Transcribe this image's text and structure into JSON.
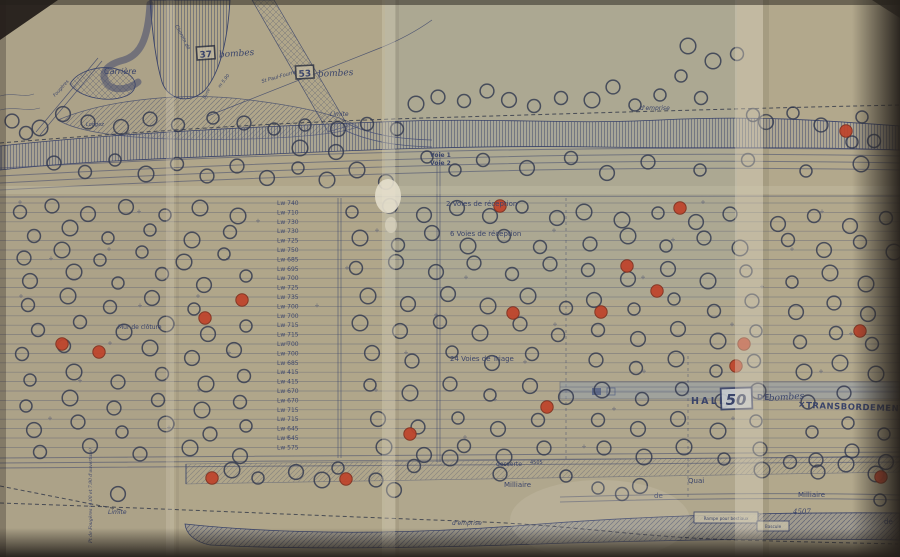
{
  "photo": {
    "paper": "#b2a88d",
    "ink": "#2e3a68",
    "red": "#c23a22",
    "dark_edge": "#241f1a",
    "fold_light": "#ddd6c1"
  },
  "bomb_boxes": [
    {
      "count": "37",
      "word": "bombes",
      "x": 197,
      "y": 57,
      "rot": -4
    },
    {
      "count": "53",
      "word": "bombes",
      "x": 296,
      "y": 76,
      "rot": -3
    }
  ],
  "halle": {
    "word1": "HALLE",
    "count": "50",
    "word2": "DE",
    "hand": "bombes",
    "mark": "×",
    "word3": "TRANSBORDEMENT"
  },
  "labels": [
    {
      "text": "Carrière",
      "x": 104,
      "y": 74,
      "size": 8,
      "italic": true
    },
    {
      "text": "Limite",
      "x": 330,
      "y": 116,
      "size": 6,
      "italic": true
    },
    {
      "text": "d'emprise",
      "x": 640,
      "y": 110,
      "size": 6,
      "italic": true
    },
    {
      "text": "Voie 1",
      "x": 430,
      "y": 157,
      "size": 6,
      "bold": true
    },
    {
      "text": "Voie 2",
      "x": 430,
      "y": 165,
      "size": 6,
      "bold": true
    },
    {
      "text": "2 Voies de réception",
      "x": 446,
      "y": 206,
      "size": 7
    },
    {
      "text": "6 Voies de réception",
      "x": 450,
      "y": 236,
      "size": 7
    },
    {
      "text": "24 Voies de Triage",
      "x": 450,
      "y": 361,
      "size": 7
    },
    {
      "text": "Mur de clôture",
      "x": 118,
      "y": 329,
      "size": 6
    },
    {
      "text": "desserte",
      "x": 496,
      "y": 466,
      "size": 6
    },
    {
      "text": "4505",
      "x": 530,
      "y": 464,
      "size": 5
    },
    {
      "text": "Milliaire",
      "x": 504,
      "y": 487,
      "size": 7
    },
    {
      "text": "Quai",
      "x": 688,
      "y": 483,
      "size": 7
    },
    {
      "text": "de",
      "x": 654,
      "y": 498,
      "size": 7
    },
    {
      "text": "Milliaire",
      "x": 798,
      "y": 497,
      "size": 7
    },
    {
      "text": "de",
      "x": 884,
      "y": 524,
      "size": 7
    },
    {
      "text": "Limite",
      "x": 108,
      "y": 514,
      "size": 6,
      "italic": true
    },
    {
      "text": "d'emprise",
      "x": 452,
      "y": 525,
      "size": 6,
      "italic": true
    },
    {
      "text": "4507",
      "x": 793,
      "y": 514,
      "size": 7,
      "hand": true
    },
    {
      "text": "Chemin de",
      "x": 175,
      "y": 26,
      "size": 5,
      "italic": true,
      "rot": 62
    },
    {
      "text": "St Paul-Fourne",
      "x": 262,
      "y": 83,
      "size": 5,
      "italic": true,
      "rot": -16
    },
    {
      "text": "m 5.90",
      "x": 220,
      "y": 88,
      "size": 4.5,
      "italic": true,
      "rot": -52
    },
    {
      "text": "Buse",
      "x": 205,
      "y": 99,
      "size": 4.5,
      "italic": true,
      "rot": -62
    },
    {
      "text": "Fougères",
      "x": 55,
      "y": 97,
      "size": 4.5,
      "italic": true,
      "rot": -48
    },
    {
      "text": "Longez",
      "x": 86,
      "y": 126,
      "size": 5,
      "italic": true
    },
    {
      "text": "Pt de Fougères (4.00 et 7.90 d'ouverture)",
      "x": 92,
      "y": 543,
      "size": 4.5,
      "rot": -90,
      "hand": true
    }
  ],
  "boxed_labels": [
    {
      "text": "Rampe pour bestiaux",
      "x": 694,
      "y": 512,
      "w": 64,
      "h": 11
    },
    {
      "text": "Bascule",
      "x": 757,
      "y": 521,
      "w": 32,
      "h": 10
    }
  ],
  "track_labels": [
    "Lw 740",
    "Lw 710",
    "Lw 730",
    "Lw 730",
    "Lw 725",
    "Lw 750",
    "Lw 685",
    "Lw 695",
    "Lw 700",
    "Lw 725",
    "Lw 735",
    "Lw 700",
    "Lw 700",
    "Lw 715",
    "Lw 715",
    "Lw 700",
    "Lw 700",
    "Lw 685",
    "Lw 415",
    "Lw 415",
    "Lw 670",
    "Lw 670",
    "Lw 715",
    "Lw 715",
    "Lw 645",
    "Lw 645",
    "Lw 575"
  ],
  "yard": {
    "rows": 27,
    "y0": 203,
    "dy": 9.4,
    "label_x": 277
  },
  "craters": {
    "black": [
      [
        688,
        46
      ],
      [
        713,
        61
      ],
      [
        737,
        54
      ],
      [
        416,
        104
      ],
      [
        438,
        97
      ],
      [
        464,
        101
      ],
      [
        487,
        91
      ],
      [
        509,
        100
      ],
      [
        534,
        106
      ],
      [
        561,
        98
      ],
      [
        592,
        100
      ],
      [
        613,
        87
      ],
      [
        635,
        105
      ],
      [
        660,
        95
      ],
      [
        681,
        76
      ],
      [
        701,
        98
      ],
      [
        753,
        115
      ],
      [
        766,
        122
      ],
      [
        793,
        113
      ],
      [
        821,
        125
      ],
      [
        852,
        142
      ],
      [
        874,
        141
      ],
      [
        862,
        117
      ],
      [
        12,
        121
      ],
      [
        26,
        133
      ],
      [
        40,
        128
      ],
      [
        63,
        114
      ],
      [
        88,
        122
      ],
      [
        121,
        127
      ],
      [
        150,
        119
      ],
      [
        178,
        125
      ],
      [
        213,
        118
      ],
      [
        244,
        123
      ],
      [
        274,
        129
      ],
      [
        305,
        125
      ],
      [
        338,
        129
      ],
      [
        367,
        124
      ],
      [
        397,
        129
      ],
      [
        54,
        163
      ],
      [
        85,
        172
      ],
      [
        115,
        160
      ],
      [
        146,
        174
      ],
      [
        177,
        164
      ],
      [
        207,
        176
      ],
      [
        237,
        166
      ],
      [
        267,
        178
      ],
      [
        298,
        168
      ],
      [
        327,
        180
      ],
      [
        357,
        170
      ],
      [
        386,
        182
      ],
      [
        300,
        148
      ],
      [
        336,
        152
      ],
      [
        427,
        157
      ],
      [
        455,
        170
      ],
      [
        483,
        160
      ],
      [
        527,
        168
      ],
      [
        571,
        158
      ],
      [
        607,
        173
      ],
      [
        648,
        162
      ],
      [
        700,
        170
      ],
      [
        748,
        160
      ],
      [
        806,
        171
      ],
      [
        861,
        164
      ],
      [
        20,
        212
      ],
      [
        52,
        206
      ],
      [
        88,
        214
      ],
      [
        126,
        207
      ],
      [
        165,
        215
      ],
      [
        200,
        208
      ],
      [
        238,
        216
      ],
      [
        352,
        212
      ],
      [
        390,
        206
      ],
      [
        424,
        215
      ],
      [
        457,
        208
      ],
      [
        490,
        216
      ],
      [
        522,
        207
      ],
      [
        557,
        218
      ],
      [
        584,
        212
      ],
      [
        622,
        220
      ],
      [
        658,
        213
      ],
      [
        696,
        222
      ],
      [
        730,
        214
      ],
      [
        778,
        224
      ],
      [
        814,
        216
      ],
      [
        850,
        226
      ],
      [
        886,
        218
      ],
      [
        34,
        236
      ],
      [
        70,
        228
      ],
      [
        108,
        238
      ],
      [
        150,
        230
      ],
      [
        192,
        240
      ],
      [
        230,
        232
      ],
      [
        360,
        238
      ],
      [
        398,
        245
      ],
      [
        432,
        233
      ],
      [
        468,
        246
      ],
      [
        504,
        236
      ],
      [
        540,
        247
      ],
      [
        590,
        244
      ],
      [
        628,
        236
      ],
      [
        666,
        246
      ],
      [
        704,
        238
      ],
      [
        740,
        248
      ],
      [
        788,
        240
      ],
      [
        824,
        250
      ],
      [
        860,
        242
      ],
      [
        894,
        252
      ],
      [
        24,
        258
      ],
      [
        62,
        250
      ],
      [
        100,
        260
      ],
      [
        142,
        252
      ],
      [
        184,
        262
      ],
      [
        224,
        254
      ],
      [
        356,
        268
      ],
      [
        396,
        262
      ],
      [
        436,
        272
      ],
      [
        474,
        263
      ],
      [
        512,
        274
      ],
      [
        550,
        264
      ],
      [
        588,
        270
      ],
      [
        628,
        279
      ],
      [
        668,
        269
      ],
      [
        708,
        281
      ],
      [
        746,
        271
      ],
      [
        792,
        282
      ],
      [
        830,
        273
      ],
      [
        866,
        284
      ],
      [
        30,
        281
      ],
      [
        74,
        272
      ],
      [
        118,
        283
      ],
      [
        162,
        274
      ],
      [
        204,
        285
      ],
      [
        246,
        276
      ],
      [
        28,
        305
      ],
      [
        68,
        296
      ],
      [
        110,
        307
      ],
      [
        152,
        298
      ],
      [
        194,
        309
      ],
      [
        368,
        296
      ],
      [
        408,
        304
      ],
      [
        448,
        294
      ],
      [
        488,
        306
      ],
      [
        528,
        296
      ],
      [
        566,
        308
      ],
      [
        594,
        300
      ],
      [
        634,
        309
      ],
      [
        674,
        299
      ],
      [
        714,
        311
      ],
      [
        752,
        301
      ],
      [
        796,
        312
      ],
      [
        834,
        303
      ],
      [
        868,
        314
      ],
      [
        38,
        330
      ],
      [
        80,
        322
      ],
      [
        124,
        332
      ],
      [
        166,
        324
      ],
      [
        208,
        334
      ],
      [
        246,
        326
      ],
      [
        360,
        323
      ],
      [
        400,
        331
      ],
      [
        440,
        322
      ],
      [
        480,
        333
      ],
      [
        520,
        324
      ],
      [
        558,
        335
      ],
      [
        598,
        330
      ],
      [
        638,
        339
      ],
      [
        678,
        329
      ],
      [
        718,
        341
      ],
      [
        756,
        331
      ],
      [
        800,
        342
      ],
      [
        836,
        333
      ],
      [
        872,
        344
      ],
      [
        22,
        354
      ],
      [
        64,
        346
      ],
      [
        150,
        348
      ],
      [
        192,
        358
      ],
      [
        234,
        350
      ],
      [
        372,
        353
      ],
      [
        412,
        361
      ],
      [
        452,
        352
      ],
      [
        492,
        363
      ],
      [
        532,
        354
      ],
      [
        596,
        360
      ],
      [
        636,
        368
      ],
      [
        676,
        359
      ],
      [
        716,
        371
      ],
      [
        754,
        361
      ],
      [
        804,
        372
      ],
      [
        840,
        363
      ],
      [
        876,
        374
      ],
      [
        30,
        380
      ],
      [
        74,
        372
      ],
      [
        118,
        382
      ],
      [
        162,
        374
      ],
      [
        206,
        384
      ],
      [
        244,
        376
      ],
      [
        370,
        385
      ],
      [
        410,
        393
      ],
      [
        450,
        384
      ],
      [
        490,
        395
      ],
      [
        530,
        386
      ],
      [
        566,
        397
      ],
      [
        602,
        390
      ],
      [
        642,
        399
      ],
      [
        682,
        389
      ],
      [
        722,
        401
      ],
      [
        758,
        391
      ],
      [
        808,
        402
      ],
      [
        844,
        393
      ],
      [
        26,
        406
      ],
      [
        70,
        398
      ],
      [
        114,
        408
      ],
      [
        158,
        400
      ],
      [
        202,
        410
      ],
      [
        240,
        402
      ],
      [
        378,
        419
      ],
      [
        418,
        427
      ],
      [
        458,
        418
      ],
      [
        498,
        429
      ],
      [
        538,
        420
      ],
      [
        598,
        420
      ],
      [
        638,
        429
      ],
      [
        678,
        419
      ],
      [
        718,
        431
      ],
      [
        756,
        421
      ],
      [
        812,
        432
      ],
      [
        848,
        423
      ],
      [
        884,
        434
      ],
      [
        34,
        430
      ],
      [
        78,
        422
      ],
      [
        122,
        432
      ],
      [
        166,
        424
      ],
      [
        210,
        434
      ],
      [
        246,
        426
      ],
      [
        384,
        447
      ],
      [
        424,
        455
      ],
      [
        464,
        446
      ],
      [
        504,
        457
      ],
      [
        544,
        448
      ],
      [
        604,
        448
      ],
      [
        644,
        457
      ],
      [
        684,
        447
      ],
      [
        724,
        459
      ],
      [
        760,
        449
      ],
      [
        816,
        460
      ],
      [
        852,
        451
      ],
      [
        886,
        462
      ],
      [
        40,
        452
      ],
      [
        90,
        446
      ],
      [
        140,
        454
      ],
      [
        190,
        448
      ],
      [
        240,
        456
      ],
      [
        232,
        470
      ],
      [
        258,
        478
      ],
      [
        296,
        472
      ],
      [
        322,
        480
      ],
      [
        376,
        480
      ],
      [
        394,
        490
      ],
      [
        338,
        468
      ],
      [
        414,
        466
      ],
      [
        450,
        458
      ],
      [
        500,
        474
      ],
      [
        566,
        476
      ],
      [
        598,
        488
      ],
      [
        622,
        494
      ],
      [
        640,
        486
      ],
      [
        762,
        470
      ],
      [
        790,
        462
      ],
      [
        818,
        472
      ],
      [
        846,
        464
      ],
      [
        876,
        474
      ],
      [
        118,
        494
      ],
      [
        880,
        500
      ]
    ],
    "red": [
      [
        500,
        206
      ],
      [
        680,
        208
      ],
      [
        846,
        131
      ],
      [
        627,
        266
      ],
      [
        657,
        291
      ],
      [
        601,
        312
      ],
      [
        513,
        313
      ],
      [
        242,
        300
      ],
      [
        205,
        318
      ],
      [
        99,
        352
      ],
      [
        62,
        344
      ],
      [
        547,
        407
      ],
      [
        744,
        344
      ],
      [
        736,
        366
      ],
      [
        860,
        331
      ],
      [
        410,
        434
      ],
      [
        346,
        479
      ],
      [
        212,
        478
      ],
      [
        881,
        477
      ]
    ]
  }
}
